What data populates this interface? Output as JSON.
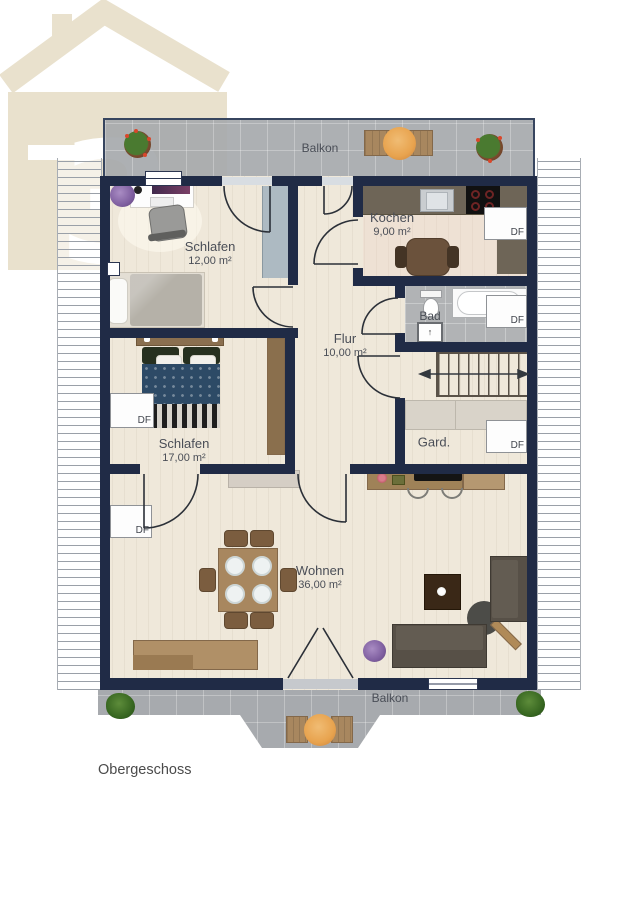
{
  "watermark": {
    "glyph": "3"
  },
  "floor_label": "Obergeschoss",
  "balconies": {
    "top": "Balkon",
    "bottom": "Balkon"
  },
  "rooms": {
    "schlafen_klein": {
      "name": "Schlafen",
      "area": "12,00 m²"
    },
    "kochen": {
      "name": "Kochen",
      "area": "9,00 m²"
    },
    "bad": {
      "name": "Bad"
    },
    "flur": {
      "name": "Flur",
      "area": "10,00 m²"
    },
    "schlafen_gross": {
      "name": "Schlafen",
      "area": "17,00 m²"
    },
    "garderobe": {
      "name": "Gard."
    },
    "wohnen": {
      "name": "Wohnen",
      "area": "36,00 m²"
    }
  },
  "roof_window_label": "DF",
  "colors": {
    "wall": "#202b46",
    "floor": "#efe8da",
    "balcony": "#a7aaae",
    "tile": "#b1b3b5",
    "watermark": "#e9e1cd",
    "wood": "#a8875f",
    "sofa": "#575047",
    "bed_cover": "#2d4a66",
    "counter": "#6e6557"
  }
}
